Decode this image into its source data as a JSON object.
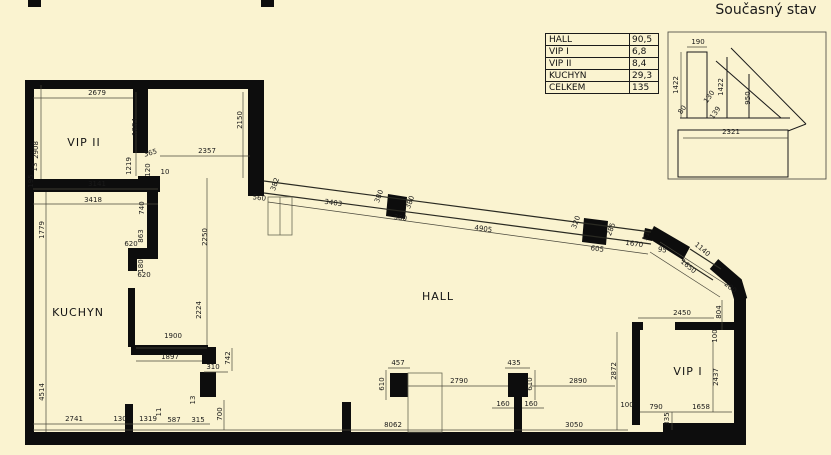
{
  "page": {
    "title": "Současný stav"
  },
  "area_table": {
    "rows": [
      {
        "name": "HALL",
        "value": "90,5"
      },
      {
        "name": "VIP I",
        "value": "6,8"
      },
      {
        "name": "VIP II",
        "value": "8,4"
      },
      {
        "name": "KUCHYN",
        "value": "29,3"
      },
      {
        "name": "CELKEM",
        "value": "135"
      }
    ]
  },
  "floorplan": {
    "rooms": [
      {
        "label": "VIP II",
        "x": 84,
        "y": 146,
        "fs": 11
      },
      {
        "label": "KUCHYN",
        "x": 78,
        "y": 316,
        "fs": 13
      },
      {
        "label": "HALL",
        "x": 438,
        "y": 300,
        "fs": 11
      },
      {
        "label": "VIP I",
        "x": 688,
        "y": 375,
        "fs": 11
      }
    ],
    "dimensions": [
      {
        "t": "2679",
        "x": 97,
        "y": 95,
        "r": 0
      },
      {
        "t": "2908",
        "x": 38,
        "y": 150,
        "r": -90
      },
      {
        "t": "1884",
        "x": 137,
        "y": 127,
        "r": -90
      },
      {
        "t": "2357",
        "x": 207,
        "y": 153,
        "r": 0
      },
      {
        "t": "2150",
        "x": 242,
        "y": 120,
        "r": -90
      },
      {
        "t": "1219",
        "x": 131,
        "y": 166,
        "r": -90
      },
      {
        "t": "365",
        "x": 151,
        "y": 155,
        "r": -15
      },
      {
        "t": "10",
        "x": 165,
        "y": 174,
        "r": 0
      },
      {
        "t": "120",
        "x": 150,
        "y": 170,
        "r": -90
      },
      {
        "t": "13",
        "x": 37,
        "y": 167,
        "r": -90
      },
      {
        "t": "195",
        "x": 33,
        "y": 181,
        "r": -90
      },
      {
        "t": "3141",
        "x": 97,
        "y": 186,
        "r": 0
      },
      {
        "t": "3418",
        "x": 93,
        "y": 202,
        "r": 0
      },
      {
        "t": "1779",
        "x": 44,
        "y": 230,
        "r": -90
      },
      {
        "t": "4514",
        "x": 44,
        "y": 392,
        "r": -90
      },
      {
        "t": "740",
        "x": 144,
        "y": 208,
        "r": -90
      },
      {
        "t": "863",
        "x": 143,
        "y": 236,
        "r": -90
      },
      {
        "t": "620",
        "x": 131,
        "y": 246,
        "r": 0
      },
      {
        "t": "180",
        "x": 143,
        "y": 266,
        "r": -90
      },
      {
        "t": "620",
        "x": 144,
        "y": 277,
        "r": 0
      },
      {
        "t": "2250",
        "x": 207,
        "y": 237,
        "r": -90
      },
      {
        "t": "2224",
        "x": 201,
        "y": 310,
        "r": -90
      },
      {
        "t": "1900",
        "x": 173,
        "y": 338,
        "r": 0
      },
      {
        "t": "1897",
        "x": 170,
        "y": 359,
        "r": 0
      },
      {
        "t": "310",
        "x": 213,
        "y": 369,
        "r": 0
      },
      {
        "t": "742",
        "x": 230,
        "y": 358,
        "r": -90
      },
      {
        "t": "13",
        "x": 195,
        "y": 400,
        "r": -90
      },
      {
        "t": "700",
        "x": 222,
        "y": 414,
        "r": -90
      },
      {
        "t": "2741",
        "x": 74,
        "y": 421,
        "r": 0
      },
      {
        "t": "130",
        "x": 120,
        "y": 421,
        "r": 0
      },
      {
        "t": "1319",
        "x": 148,
        "y": 421,
        "r": 0
      },
      {
        "t": "11",
        "x": 161,
        "y": 412,
        "r": -90
      },
      {
        "t": "587",
        "x": 174,
        "y": 422,
        "r": 0
      },
      {
        "t": "315",
        "x": 198,
        "y": 422,
        "r": 0
      },
      {
        "t": "560",
        "x": 259,
        "y": 200,
        "r": 8
      },
      {
        "t": "382",
        "x": 277,
        "y": 185,
        "r": -70
      },
      {
        "t": "3403",
        "x": 333,
        "y": 205,
        "r": 8
      },
      {
        "t": "380",
        "x": 381,
        "y": 197,
        "r": -70
      },
      {
        "t": "380",
        "x": 412,
        "y": 203,
        "r": -70
      },
      {
        "t": "360",
        "x": 400,
        "y": 220,
        "r": 8
      },
      {
        "t": "4905",
        "x": 483,
        "y": 231,
        "r": 8
      },
      {
        "t": "320",
        "x": 578,
        "y": 223,
        "r": -70
      },
      {
        "t": "285",
        "x": 613,
        "y": 230,
        "r": -70
      },
      {
        "t": "605",
        "x": 597,
        "y": 251,
        "r": 8
      },
      {
        "t": "1670",
        "x": 634,
        "y": 246,
        "r": 8
      },
      {
        "t": "11",
        "x": 648,
        "y": 237,
        "r": -70
      },
      {
        "t": "95",
        "x": 662,
        "y": 252,
        "r": 8
      },
      {
        "t": "1140",
        "x": 701,
        "y": 251,
        "r": 40
      },
      {
        "t": "1650",
        "x": 687,
        "y": 268,
        "r": 40
      },
      {
        "t": "280",
        "x": 729,
        "y": 289,
        "r": 40
      },
      {
        "t": "804",
        "x": 721,
        "y": 312,
        "r": -90
      },
      {
        "t": "2450",
        "x": 682,
        "y": 315,
        "r": 0
      },
      {
        "t": "100",
        "x": 717,
        "y": 336,
        "r": -90
      },
      {
        "t": "2437",
        "x": 718,
        "y": 377,
        "r": -90
      },
      {
        "t": "2872",
        "x": 616,
        "y": 371,
        "r": -90
      },
      {
        "t": "100",
        "x": 627,
        "y": 407,
        "r": 0
      },
      {
        "t": "790",
        "x": 656,
        "y": 409,
        "r": 0
      },
      {
        "t": "1658",
        "x": 701,
        "y": 409,
        "r": 0
      },
      {
        "t": "335",
        "x": 669,
        "y": 419,
        "r": -90
      },
      {
        "t": "457",
        "x": 398,
        "y": 365,
        "r": 0
      },
      {
        "t": "610",
        "x": 384,
        "y": 384,
        "r": -90
      },
      {
        "t": "2790",
        "x": 459,
        "y": 383,
        "r": 0
      },
      {
        "t": "435",
        "x": 514,
        "y": 365,
        "r": 0
      },
      {
        "t": "610",
        "x": 532,
        "y": 384,
        "r": -90
      },
      {
        "t": "160",
        "x": 503,
        "y": 406,
        "r": 0
      },
      {
        "t": "160",
        "x": 531,
        "y": 406,
        "r": 0
      },
      {
        "t": "2890",
        "x": 578,
        "y": 383,
        "r": 0
      },
      {
        "t": "8062",
        "x": 393,
        "y": 427,
        "r": 0
      },
      {
        "t": "3050",
        "x": 574,
        "y": 427,
        "r": 0
      }
    ],
    "detail_dimensions": [
      {
        "t": "190",
        "x": 698,
        "y": 44,
        "r": 0
      },
      {
        "t": "1422",
        "x": 678,
        "y": 85,
        "r": -90
      },
      {
        "t": "1422",
        "x": 723,
        "y": 87,
        "r": -90
      },
      {
        "t": "950",
        "x": 750,
        "y": 98,
        "r": -90
      },
      {
        "t": "2321",
        "x": 731,
        "y": 134,
        "r": 0
      },
      {
        "t": "130",
        "x": 711,
        "y": 98,
        "r": -55
      },
      {
        "t": "80",
        "x": 684,
        "y": 111,
        "r": -55
      },
      {
        "t": "139",
        "x": 717,
        "y": 114,
        "r": -55
      }
    ]
  },
  "colors": {
    "background": "#FAF3D0",
    "wall": "#0D0D0D",
    "dim_line": "#4a483c",
    "text": "#1A1A1A"
  }
}
